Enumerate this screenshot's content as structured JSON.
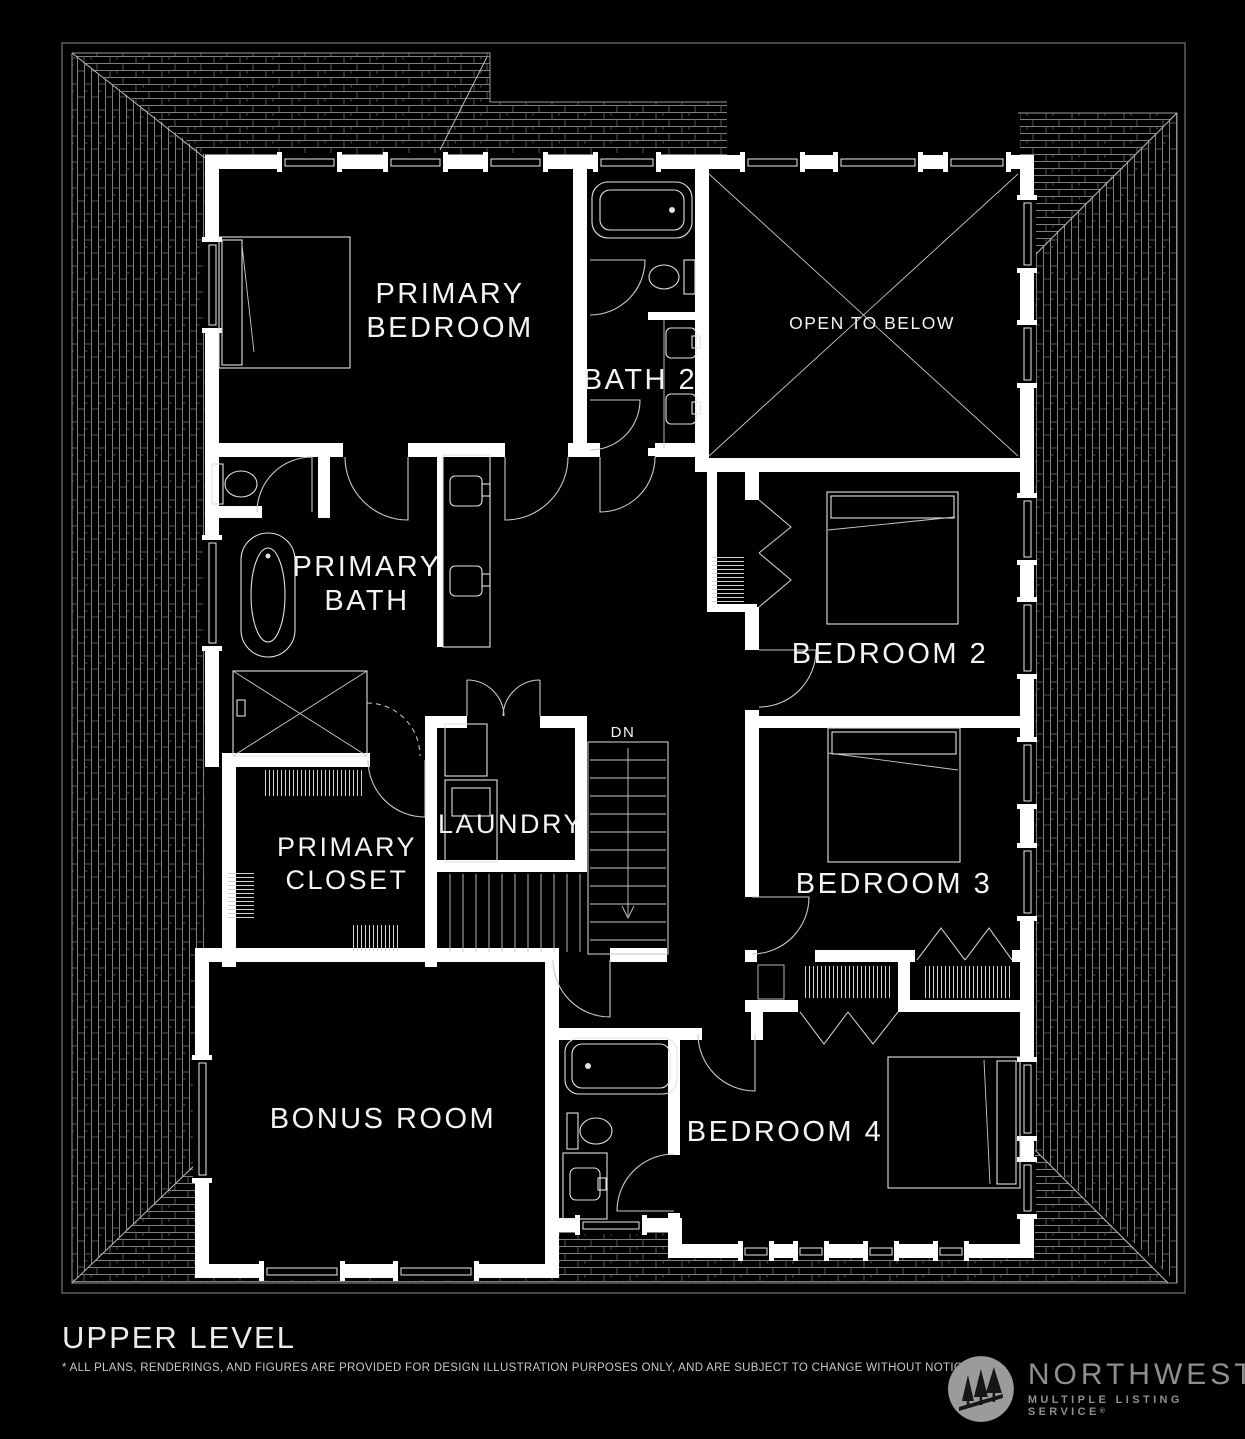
{
  "colors": {
    "background": "#000000",
    "wall": "#ffffff",
    "line": "#c9c9c9",
    "fixture": "#e2e2e2",
    "label": "#f4f4f4",
    "roofline": "#9a9a9a",
    "footer_text": "#ececec",
    "disclaimer_text": "#c9c9c9",
    "logo_gray": "#8f8f8f"
  },
  "plan": {
    "labels": {
      "primary_bedroom_line1": "PRIMARY",
      "primary_bedroom_line2": "BEDROOM",
      "bath2": "BATH 2",
      "open_to_below": "OPEN TO BELOW",
      "primary_bath_line1": "PRIMARY",
      "primary_bath_line2": "BATH",
      "bedroom2": "BEDROOM 2",
      "laundry": "LAUNDRY",
      "primary_closet_line1": "PRIMARY",
      "primary_closet_line2": "CLOSET",
      "bedroom3": "BEDROOM 3",
      "bonus_room": "BONUS ROOM",
      "bedroom4": "BEDROOM 4",
      "stairs_down": "DN"
    }
  },
  "footer": {
    "title": "UPPER LEVEL",
    "disclaimer": "* ALL PLANS, RENDERINGS, AND FIGURES ARE PROVIDED FOR DESIGN ILLUSTRATION PURPOSES ONLY, AND ARE SUBJECT TO CHANGE WITHOUT NOTICE"
  },
  "logo": {
    "name": "NORTHWEST",
    "tagline": "MULTIPLE LISTING SERVICE",
    "registered": "®"
  }
}
